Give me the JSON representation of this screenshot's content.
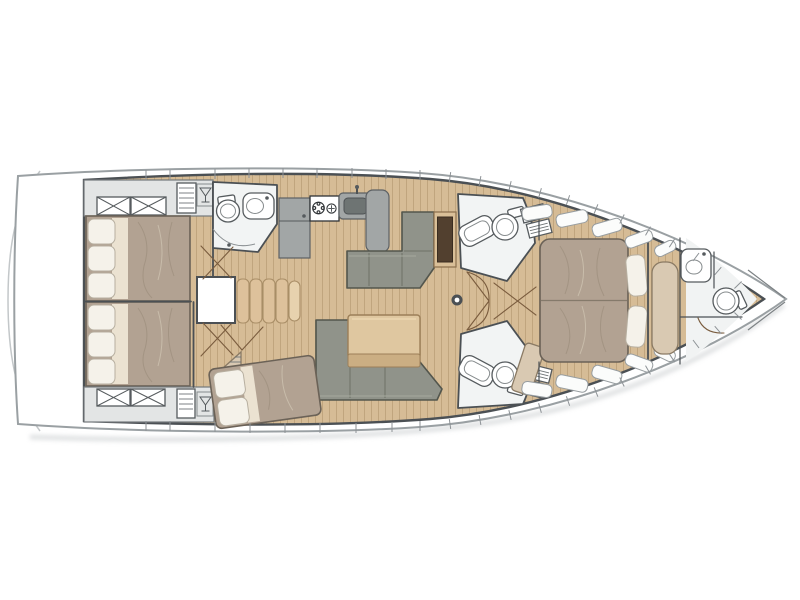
{
  "plan": {
    "vessel": "sailing-yacht-monohull",
    "view": "top-down interior layout plan, bow pointing right",
    "bow_direction": "right",
    "stern_direction": "left",
    "rooms": [
      {
        "name": "aft-cabin-port",
        "fixtures": [
          "double-bed",
          "pillows",
          "wardrobe-x-lockers",
          "slat-locker",
          "wine-glass-cabinet"
        ]
      },
      {
        "name": "aft-cabin-starboard",
        "fixtures": [
          "double-bed",
          "pillows",
          "wardrobe-x-lockers",
          "slat-locker",
          "wine-glass-cabinet"
        ]
      },
      {
        "name": "aft-head-port",
        "fixtures": [
          "toilet",
          "sink-vanity",
          "shower-arc"
        ]
      },
      {
        "name": "galley",
        "fixtures": [
          "fridge",
          "two-burner-stove",
          "sink",
          "counter"
        ]
      },
      {
        "name": "companionway",
        "fixtures": [
          "stairs",
          "opening"
        ]
      },
      {
        "name": "salon",
        "fixtures": [
          "l-sofa-port",
          "l-sofa-starboard",
          "folding-table",
          "dark-chart-panel",
          "mast-post"
        ]
      },
      {
        "name": "mid-cabin-starboard",
        "fixtures": [
          "angled-double-bed",
          "pillows",
          "striped-corner-shelf"
        ]
      },
      {
        "name": "ensuite-head-port",
        "fixtures": [
          "toilet",
          "sink",
          "vent-grilles",
          "door-swing"
        ]
      },
      {
        "name": "ensuite-head-starboard",
        "fixtures": [
          "toilet",
          "sink",
          "vent-grilles",
          "door-swing"
        ]
      },
      {
        "name": "master-cabin",
        "fixtures": [
          "island-double-bed",
          "pillows",
          "hull-lockers",
          "bench-seat"
        ]
      },
      {
        "name": "bow-head",
        "fixtures": [
          "toilet",
          "sink-vanity"
        ]
      },
      {
        "name": "bow-locker",
        "fixtures": [
          "anchor-locker-seams"
        ]
      }
    ],
    "icons": [
      "wine-glass-icon",
      "hatch-x-icon",
      "vent-grille-icon",
      "burner-icon",
      "mast-post-icon"
    ]
  },
  "colors": {
    "hull": "#9aa0a3",
    "wall": "#4b5054",
    "wood": "#d6bc96",
    "wood_line": "#c0a57e",
    "headfloor": "#f2f4f4",
    "wardrobe": "#e3e5e5",
    "counter": "#a2a6a6",
    "counter_dark": "#6e7473",
    "duvet": "#b2a292",
    "sheet": "#ebe2d1",
    "pillow": "#f5f2ea",
    "sofa": "#90938a",
    "table": "#dfc7a0",
    "table_band": "#cbae83",
    "panel_dark": "#52402f",
    "panel_frame": "#d9bf98",
    "bench": "#d9c9b2",
    "steps": "#ddc19b",
    "door": "#7a5c3e",
    "stove": "#ffffff",
    "bow_floor": "#f1f3f3",
    "shadow": "#c7cbcd",
    "background": "#ffffff"
  }
}
